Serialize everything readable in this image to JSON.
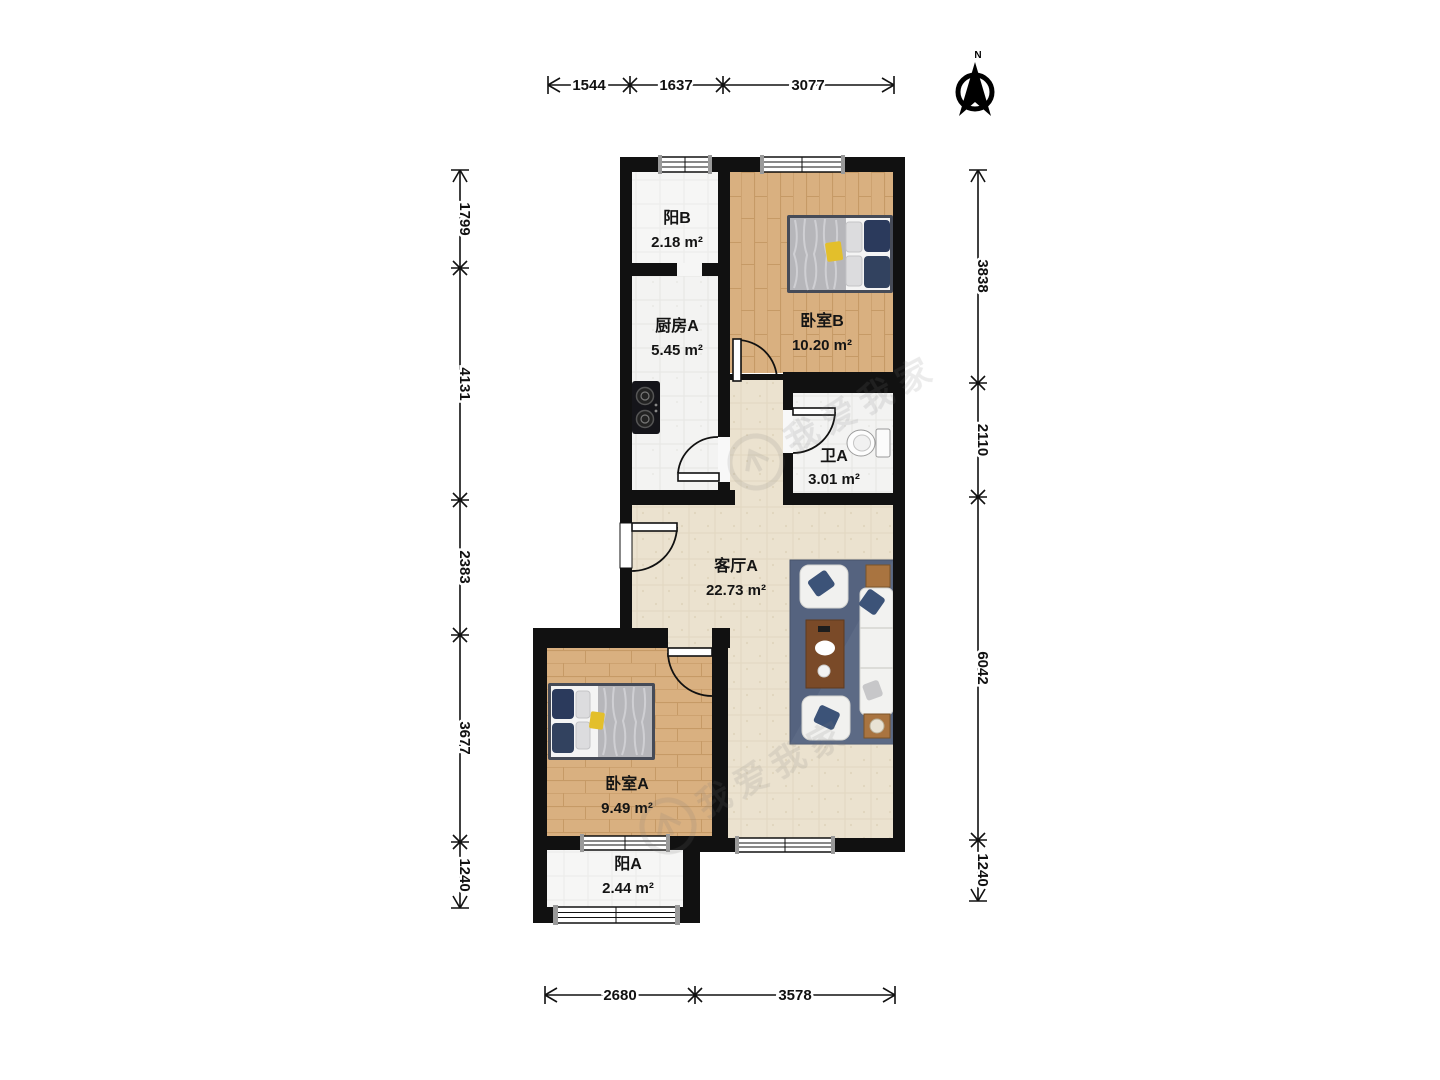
{
  "compass": {
    "label": "N"
  },
  "rooms": [
    {
      "id": "balcony-b",
      "name": "阳B",
      "area": "2.18 m²"
    },
    {
      "id": "kitchen-a",
      "name": "厨房A",
      "area": "5.45 m²"
    },
    {
      "id": "bedroom-b",
      "name": "卧室B",
      "area": "10.20 m²"
    },
    {
      "id": "bath-a",
      "name": "卫A",
      "area": "3.01 m²"
    },
    {
      "id": "living-a",
      "name": "客厅A",
      "area": "22.73 m²"
    },
    {
      "id": "bedroom-a",
      "name": "卧室A",
      "area": "9.49 m²"
    },
    {
      "id": "balcony-a",
      "name": "阳A",
      "area": "2.44 m²"
    }
  ],
  "dimensions": {
    "top": [
      "1544",
      "1637",
      "3077"
    ],
    "bottom": [
      "2680",
      "3578"
    ],
    "left": [
      "1799",
      "4131",
      "2383",
      "3677",
      "1240"
    ],
    "right": [
      "3838",
      "2110",
      "6042",
      "1240"
    ]
  },
  "watermark": {
    "text": "我爱我家"
  },
  "colors": {
    "wall": "#111111",
    "wood_floor": "#d9b080",
    "living_floor": "#ebe2cf",
    "tile_floor": "#f3f3f2",
    "rug": "#55637f",
    "pillow_navy": "#2b3a5c",
    "accent_yellow": "#e3bf2b",
    "table_wood": "#7a4a28"
  }
}
